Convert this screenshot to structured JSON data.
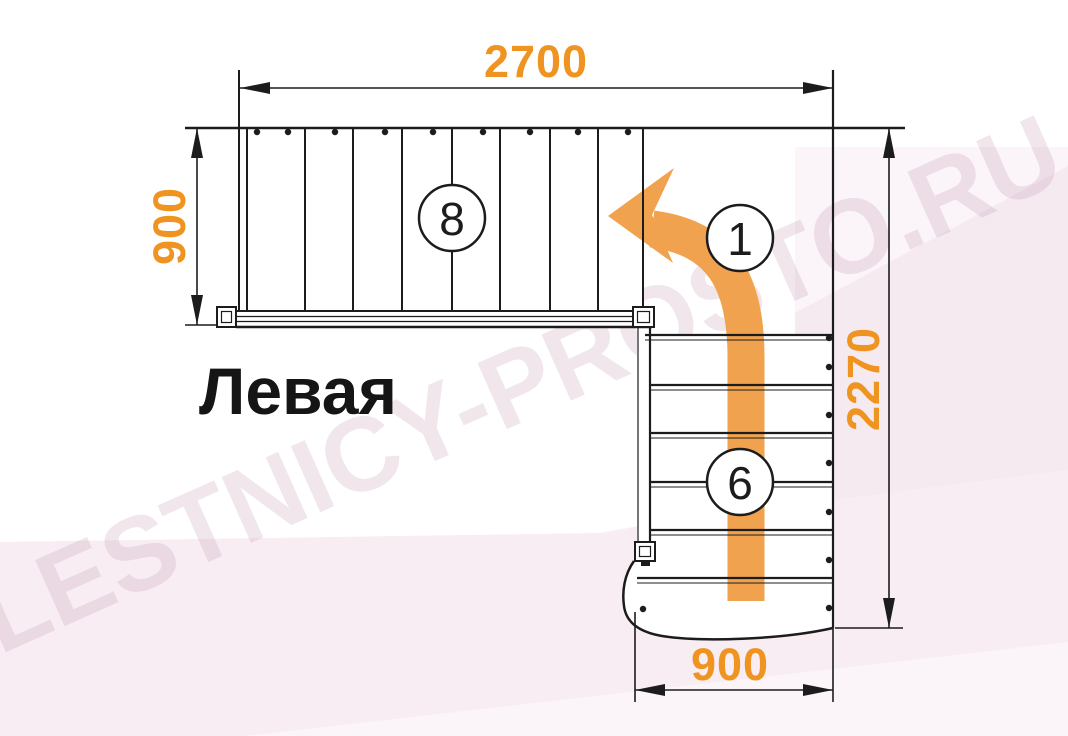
{
  "diagram": {
    "title": "Левая",
    "watermark": "LESTNICY-PROSTO.RU",
    "dimensions": {
      "top": "2700",
      "left": "900",
      "right": "2270",
      "bottom": "900"
    },
    "step_counts": {
      "upper_flight": "8",
      "turn": "1",
      "lower_flight": "6"
    }
  },
  "colors": {
    "orange_text": "#EF9421",
    "orange_arrow": "#F1A24E",
    "line_black": "#1c1c1c",
    "pink_main": "#F8EDF3",
    "pink_mid": "#F6EAF1",
    "pink_light": "#FBF4F8",
    "watermark": "rgba(186,140,170,0.22)"
  }
}
